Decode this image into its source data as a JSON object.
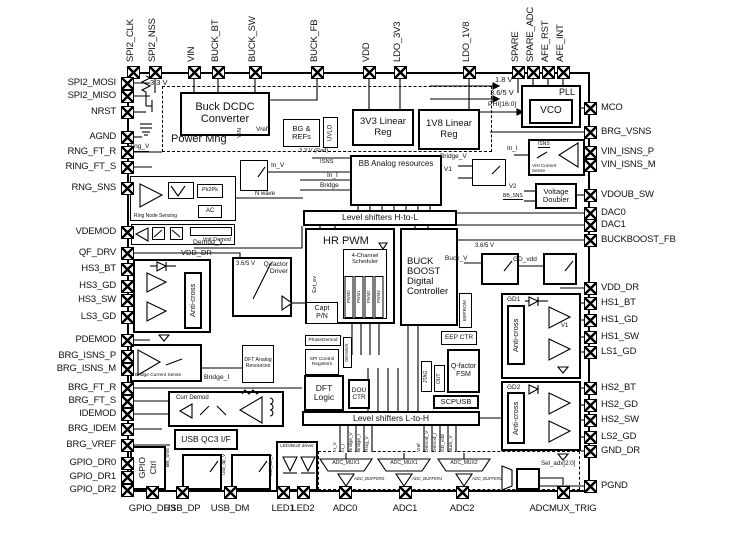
{
  "pins": {
    "top": [
      "SPI2_CLK",
      "SPI2_NSS",
      "VIN",
      "BUCK_BT",
      "BUCK_SW",
      "BUCK_FB",
      "VDD",
      "LDO_3V3",
      "LDO_1V8",
      "SPARE",
      "SPARE_ADC",
      "AFE_RST",
      "AFE_INT"
    ],
    "left": [
      "SPI2_MOSI",
      "SPI2_MISO",
      "NRST",
      "AGND",
      "RNG_FT_R",
      "RING_FT_S",
      "RNG_SNS",
      "VDEMOD",
      "QF_DRV",
      "HS3_BT",
      "HS3_GD",
      "HS3_SW",
      "LS3_GD",
      "PDEMOD",
      "BRG_ISNS_P",
      "BRG_ISNS_M",
      "BRG_FT_R",
      "BRG_FT_S",
      "IDEMOD",
      "BRG_IDEM",
      "BRG_VREF",
      "GPIO_DR0",
      "GPIO_DR1",
      "GPIO_DR2"
    ],
    "right": [
      "MCO",
      "BRG_VSNS",
      "VIN_ISNS_P",
      "VIN_ISNS_M",
      "VDOUB_SW",
      "DAC0",
      "DAC1",
      "BUCKBOOST_FB",
      "VDD_DR",
      "HS1_BT",
      "HS1_GD",
      "HS1_SW",
      "LS1_GD",
      "HS2_BT",
      "HS2_GD",
      "HS2_SW",
      "LS2_GD",
      "GND_DR",
      "PGND"
    ],
    "bottom": [
      "GPIO_DR3",
      "USB_DP",
      "USB_DM",
      "LED1",
      "LED2",
      "ADC0",
      "ADC1",
      "ADC2",
      "ADCMUX_TRIG"
    ]
  },
  "blocks": {
    "power_mng": "Power Mng",
    "buck_dcdc": "Buck DCDC Converter",
    "bg_refs": "BG & REFs",
    "uvlo": "UVLO",
    "reg3v3": "3V3 Linear Reg",
    "reg1v8": "1V8 Linear Reg",
    "pll": "PLL",
    "vco": "VCO",
    "bb_analog": "BB Analog resources",
    "ring_sense": "Ring Node Sensing",
    "pk2pk": "Pk2Pk",
    "ac": "AC",
    "volt_demod": "Volt Demod",
    "ls_htol": "Level shifters H-to-L",
    "hr_pwm": "HR PWM",
    "scheduler": "4-Channel Scheduler",
    "capt": "Capt P/N",
    "buckboost": "BUCK BOOST Digital Controller",
    "qf_driver": "Q-factor Driver",
    "anti_cross": "Anti-cross",
    "bridge_cur_sense": "Bridge Current Sense",
    "dft_analog": "DFT Analog Resources",
    "curr_demod": "Curr Demod",
    "phasedemod": "PhaseDemod",
    "spi_ctrl": "SPI Control Registers",
    "genmux": "GENMUX",
    "dft_logic": "DFT Logic",
    "dou_ctr": "DOU CTR",
    "jtag": "JTAG",
    "out": "OUT",
    "qf_fsm": "Q-factor FSM",
    "eeprom": "EEPROM",
    "eep_ctr": "EEP CTR",
    "scpusb": "SCPUSB",
    "ls_ltoh": "Level shifters L-to-H",
    "vin_cur_sense": "VIN Current Sense",
    "volt_doubler": "Voltage Doubler",
    "gd1": "GD1",
    "gd2": "GD2",
    "gpio": "GPIO",
    "ctrl": "Ctrl",
    "usb_qc3": "USB QC3 I/F",
    "led_driver": "LED/BUZ driver",
    "usb_dp_v": "Usb_dp_V",
    "usb_dm_v": "Usb_dm_V"
  },
  "pwm_channels": [
    "PWM0",
    "PWM1",
    "PWM2",
    "PWM3"
  ],
  "adc": {
    "muxes": [
      "ADC_MUX1",
      "ADC_MUX1",
      "ADC_MUX2"
    ],
    "buffers": [
      "ADC_BUFFER0",
      "ADC_BUFFER1",
      "ADC_BUFFER2"
    ],
    "sel": "Sel_adx[2:0]"
  },
  "nets": {
    "v33": "3.3 V",
    "ring_v": "Ring_V",
    "vin_rail": "VIN",
    "vref": "Vref",
    "v18": "1.8 V",
    "v365": "3.6/5 V",
    "phi": "PHI[16:0]",
    "v33_pad": "3.3 V (Pad)",
    "isns": "ISNS",
    "in_i": "In_I",
    "bridge": "Bridge",
    "in_v": "In_V",
    "n_wave": "N wave",
    "demod_v": "Demod_V",
    "vdd_dr": "VDD_DR",
    "bridge_i": "Bridge_I",
    "bridge_v": "Bridge_V",
    "v1": "V1",
    "v2": "V2",
    "bb_sns": "BB_SNS",
    "buck_v": "Buck_V",
    "gd_vdd": "GD_vdd",
    "ext_ev": "Ext_ev"
  },
  "wire_labels": [
    "In_V",
    "In_I",
    "Bridge_V",
    "Bridge_I",
    "Ring_V",
    "Vref",
    "Demod_V",
    "Demod_I",
    "GD_vdd",
    "Buck_V"
  ]
}
